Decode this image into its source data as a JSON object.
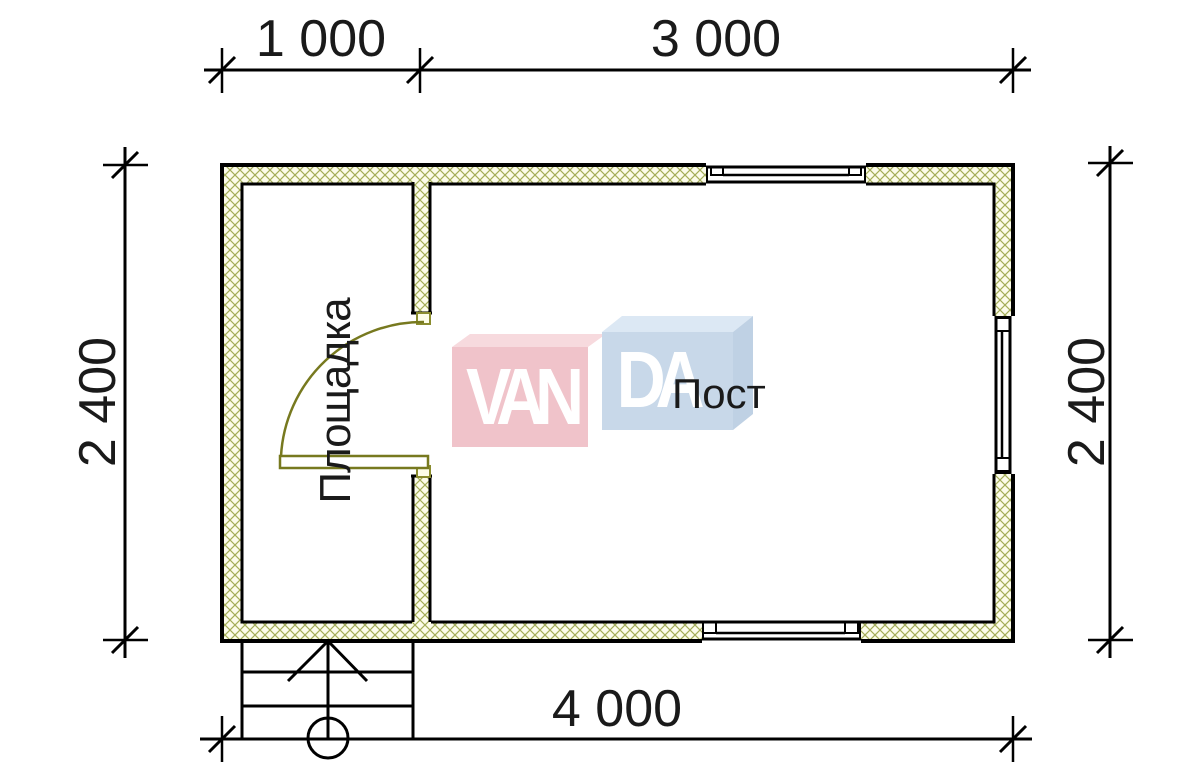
{
  "drawing": {
    "type": "floor-plan",
    "dimensions": {
      "top_left": "1 000",
      "top_right": "3 000",
      "left": "2 400",
      "right": "2 400",
      "bottom": "4 000"
    },
    "rooms": [
      {
        "name": "Площадка"
      },
      {
        "name": "Пост"
      }
    ],
    "watermark": {
      "part1": "VAN",
      "part2": "DA"
    },
    "colors": {
      "line": "#000000",
      "hatch_line": "#a4ad58",
      "hatch_fill": "#fcfcea",
      "door": "#77791f",
      "logo_pink_front": "#f0c3ca",
      "logo_pink_top": "#f7dade",
      "logo_blue_front": "#c8d8e9",
      "logo_blue_top": "#dce8f4",
      "logo_blue_side": "#bfd1e4",
      "text": "#1a1a1a"
    }
  }
}
